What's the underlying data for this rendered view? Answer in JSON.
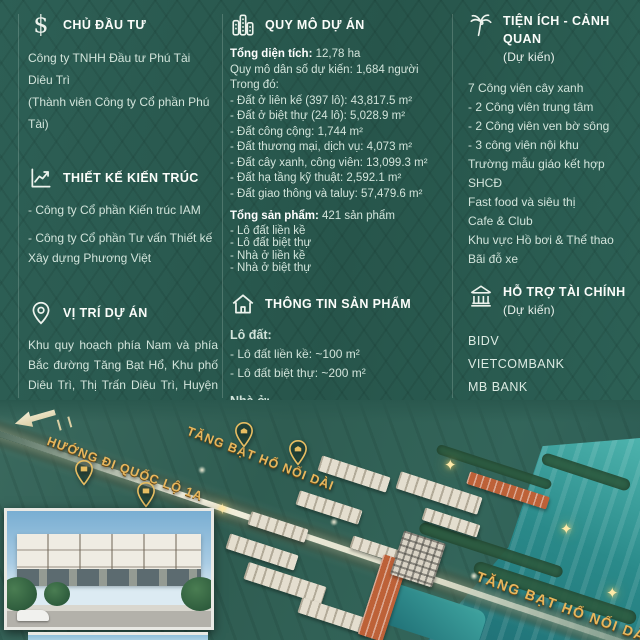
{
  "theme": {
    "background": "#2a5a50",
    "gold": "#e6b75f",
    "text": "#d2e4db",
    "heading": "#fbfdfa",
    "river": "#2a8a8a"
  },
  "left": {
    "investor": {
      "title": "CHỦ ĐẦU TƯ",
      "lines": [
        "Công ty TNHH Đầu tư Phú Tài Diêu Trì",
        "(Thành viên Công ty Cổ phần Phú Tài)"
      ]
    },
    "design": {
      "title": "THIẾT KẾ KIẾN TRÚC",
      "items": [
        "- Công ty Cổ phần Kiến trúc IAM",
        "- Công ty Cổ phần Tư vấn Thiết kế Xây dựng Phương Việt"
      ]
    },
    "location": {
      "title": "VỊ TRÍ DỰ ÁN",
      "text": "Khu quy hoạch phía Nam và phía Bắc đường Tăng Bạt Hổ, Khu phố Diêu Trì, Thị Trấn Diêu Trì, Huyện Tuy Phước, Tỉnh Bình Định"
    },
    "legal": {
      "title": "PHÁP LÝ SỞ HỮU",
      "text": "Sở hữu lâu dài"
    }
  },
  "middle": {
    "scale": {
      "title": "QUY MÔ DỰ ÁN",
      "total_area_label": "Tổng diện tích:",
      "total_area_value": " 12,78 ha",
      "population": "Quy mô dân số dự kiến: 1,684 người",
      "including": "Trong đó:",
      "land_items": [
        "- Đất ở liên kế (397 lô): 43,817.5 m²",
        "- Đất ở biệt thự (24 lô): 5,028.9 m²",
        "- Đất công cộng: 1,744 m²",
        "- Đất thương mại, dịch vụ: 4,073 m²",
        "- Đất cây xanh, công viên: 13,099.3 m²",
        "- Đất hạ tầng kỹ thuật: 2,592.1 m²",
        "- Đất giao thông và taluy: 57,479.6 m²"
      ],
      "total_products_label": "Tổng sản phẩm:",
      "total_products_value": " 421 sản phẩm",
      "product_types": [
        "- Lô đất liền kề",
        "- Lô đất biệt thự",
        "- Nhà ở liền kề",
        "- Nhà ở biệt thự"
      ]
    },
    "product_info": {
      "title": "THÔNG TIN SẢN PHẨM",
      "land_label": "Lô đất:",
      "land_items": [
        "- Lô đất liền kề: ~100 m²",
        "- Lô đất biệt thự: ~200 m²"
      ],
      "house_label": "Nhà ở:",
      "house_items": [
        "- Nhà ở liền kề: ~100 m²",
        "- Nhà ở biệt thự: ~230 m²"
      ]
    }
  },
  "right": {
    "amenities": {
      "title": "TIỆN ÍCH - CẢNH QUAN",
      "subtitle": "(Dự kiến)",
      "items": [
        "7 Công viên cây xanh",
        "- 2 Công viên trung tâm",
        "- 2 Công viên ven bờ sông",
        "- 3 công viên nội khu",
        "Trường mẫu giáo kết hợp SHCĐ",
        "Fast food và siêu thị",
        "Cafe & Club",
        "Khu vực Hồ bơi & Thể thao",
        "Bãi đỗ xe"
      ]
    },
    "finance": {
      "title": "HỖ TRỢ TÀI CHÍNH",
      "subtitle": "(Dự kiến)",
      "banks": [
        "BIDV",
        "VIETCOMBANK",
        "MB BANK",
        "OCB",
        "VPB"
      ]
    }
  },
  "map": {
    "direction_label": "HƯỚNG ĐI QUỐC LỘ 1A",
    "road_label_top": "TĂNG BẠT HỔ NỐI DÀI",
    "road_label_bottom": "TĂNG BẠT HỔ NỐI DÀI"
  }
}
